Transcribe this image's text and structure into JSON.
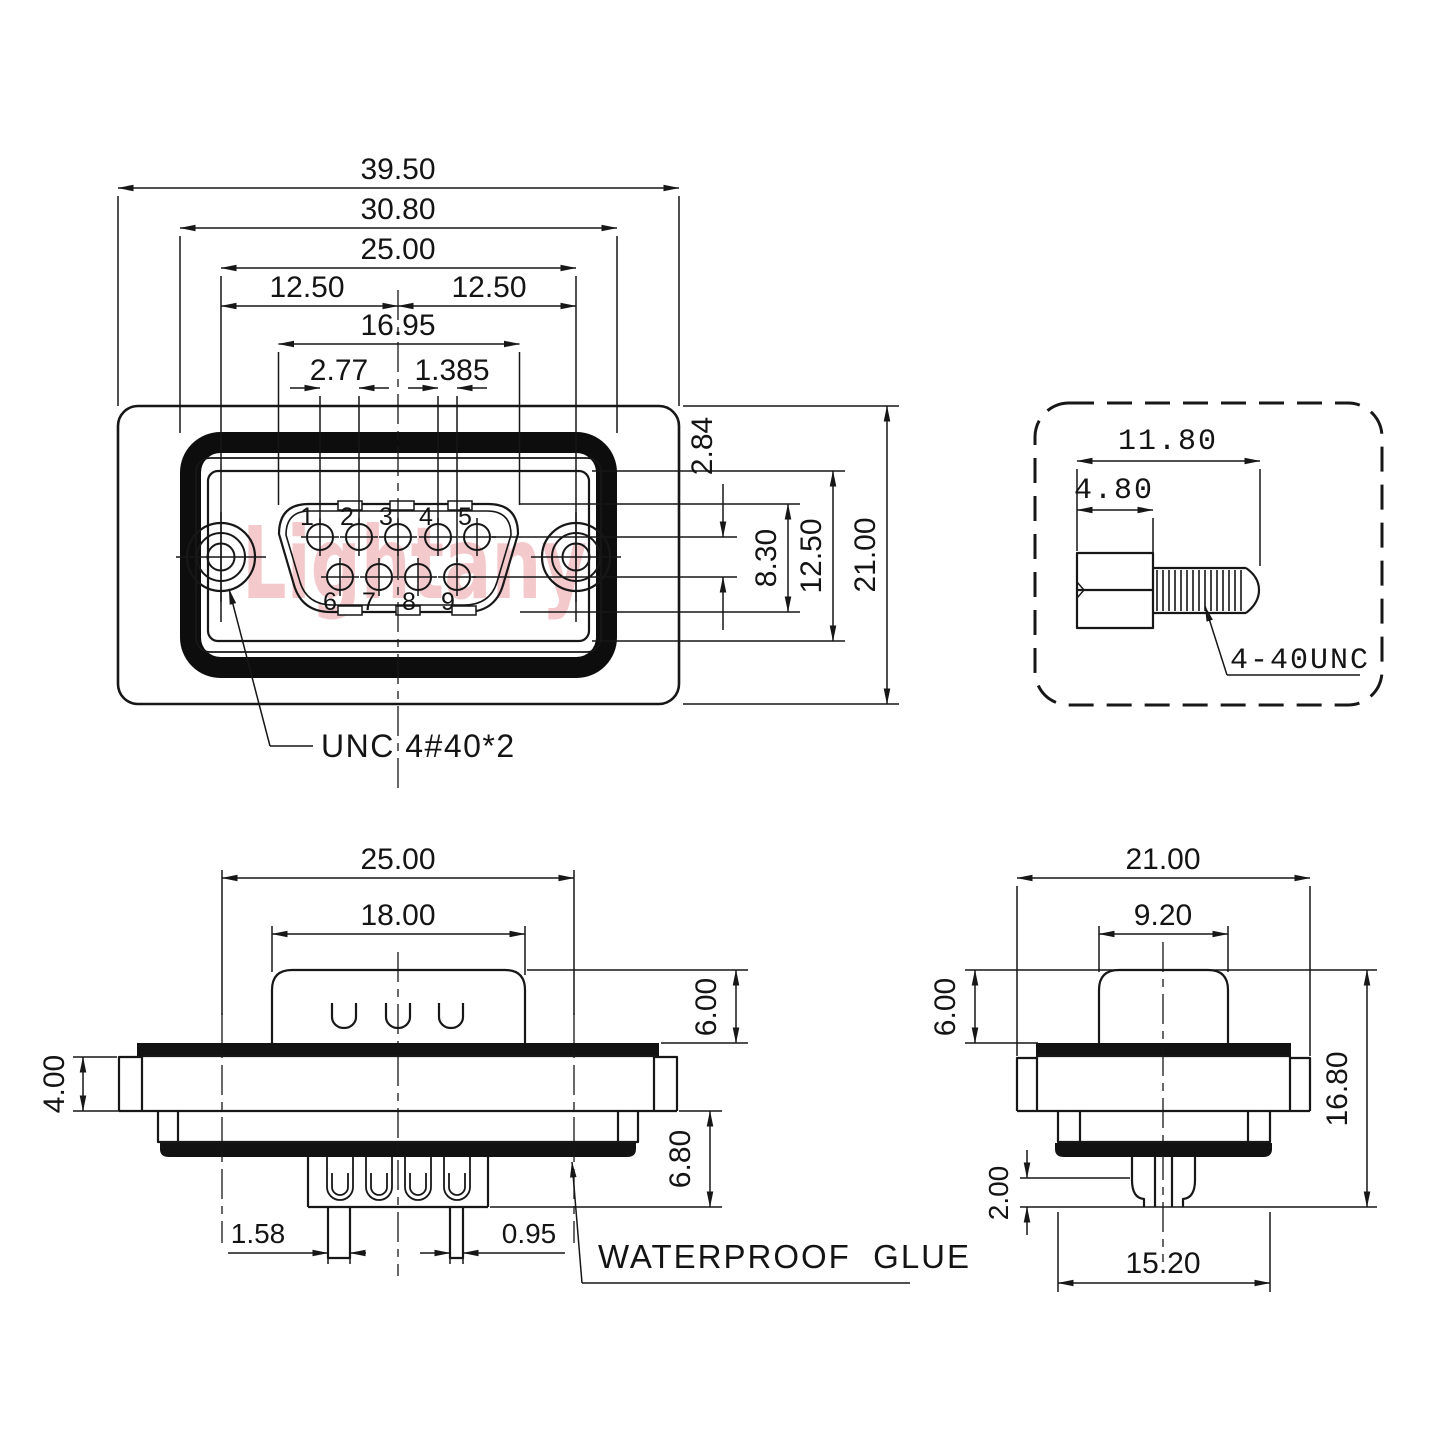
{
  "watermark": {
    "text": "Lightany",
    "color": "#f4c9cb"
  },
  "front": {
    "d_39_50": "39.50",
    "d_30_80": "30.80",
    "d_25_00": "25.00",
    "d_12_50_left": "12.50",
    "d_12_50_right": "12.50",
    "d_16_95": "16.95",
    "d_2_77": "2.77",
    "d_1_385": "1.385",
    "d_2_84": "2.84",
    "d_8_30": "8.30",
    "d_12_50_vert": "12.50",
    "d_21_00": "21.00",
    "pins": [
      "1",
      "2",
      "3",
      "4",
      "5",
      "6",
      "7",
      "8",
      "9"
    ],
    "screw_note": "UNC 4#40*2"
  },
  "screw_detail": {
    "d_11_80": "11.80",
    "d_4_80": "4.80",
    "thread_label": "4-40UNC"
  },
  "side_view": {
    "d_25_00": "25.00",
    "d_18_00": "18.00",
    "d_6_00": "6.00",
    "d_4_00": "4.00",
    "d_6_80": "6.80",
    "d_1_58": "1.58",
    "d_0_95": "0.95",
    "glue_label": "WATERPROOF  GLUE"
  },
  "end_view": {
    "d_21_00": "21.00",
    "d_9_20": "9.20",
    "d_6_00": "6.00",
    "d_16_80": "16.80",
    "d_2_00": "2.00",
    "d_15_20": "15.20"
  }
}
